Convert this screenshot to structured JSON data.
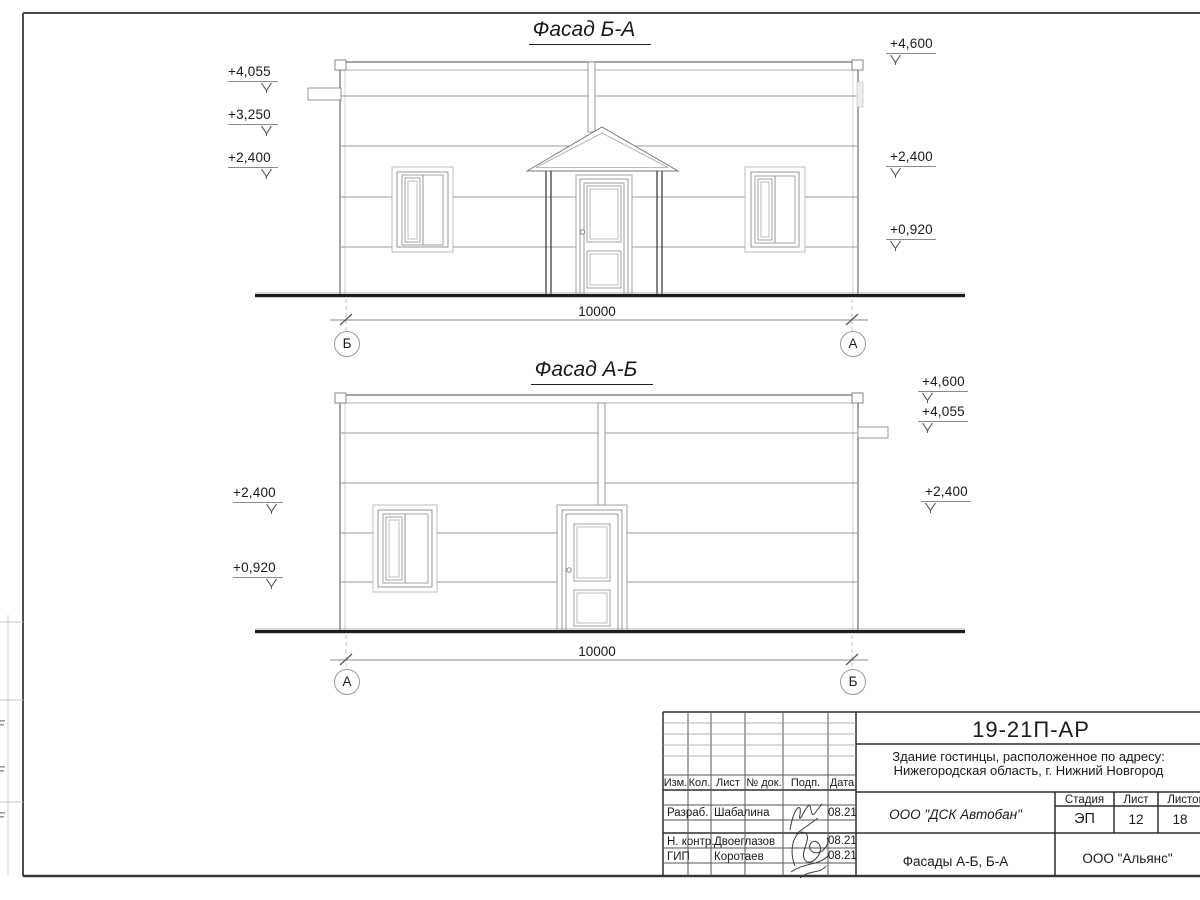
{
  "colors": {
    "ink": "#1a1a1a",
    "wall_line": "#6a6a6a",
    "thin_line": "#9a9a9a",
    "ground": "#1c1c1c",
    "frame": "#4d4d4d"
  },
  "facades": [
    {
      "title": "Фасад Б-А",
      "dimension": "10000",
      "axis_left": "Б",
      "axis_right": "А",
      "marks_left": [
        "+4,055",
        "+3,250",
        "+2,400"
      ],
      "marks_right": [
        "+4,600",
        "+2,400",
        "+0,920"
      ]
    },
    {
      "title": "Фасад А-Б",
      "dimension": "10000",
      "axis_left": "А",
      "axis_right": "Б",
      "marks_left": [
        "+2,400",
        "+0,920"
      ],
      "marks_right": [
        "+4,600",
        "+4,055",
        "+2,400"
      ]
    }
  ],
  "title_block": {
    "doc_number": "19-21П-АР",
    "object_line1": "Здание гостинцы, расположенное по адресу:",
    "object_line2": "Нижегородская область, г. Нижний Новгород",
    "rev_headers": [
      "Изм.",
      "Кол.",
      "Лист",
      "№ док.",
      "Подп.",
      "Дата"
    ],
    "signers": [
      {
        "role": "Разраб.",
        "name": "Шабалина",
        "date": "08.21"
      },
      {
        "role": "Н. контр.",
        "name": "Двоеглазов",
        "date": "08.21"
      },
      {
        "role": "ГИП",
        "name": "Коротаев",
        "date": "08.21"
      }
    ],
    "company": "ООО \"ДСК Автобан\"",
    "stage_label": "Стадия",
    "sheet_label": "Лист",
    "sheets_label": "Листов",
    "stage_value": "ЭП",
    "sheet_value": "12",
    "sheets_value": "18",
    "drawing_title": "Фасады А-Б, Б-А",
    "contractor": "ООО \"Альянс\""
  }
}
